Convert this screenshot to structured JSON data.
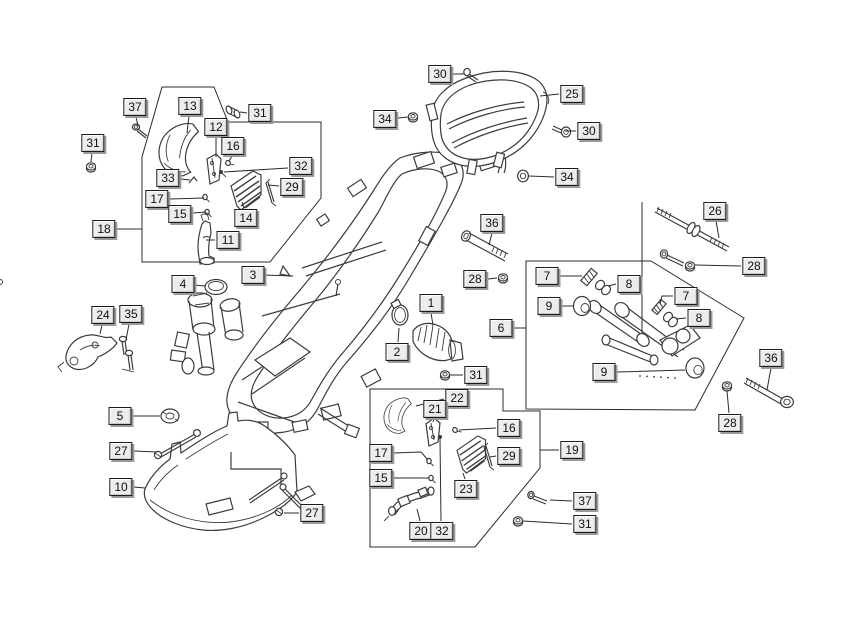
{
  "diagram": {
    "type": "exploded-parts-diagram",
    "subject": "scooter frame and footrest assembly",
    "colors": {
      "bg": "#ffffff",
      "line": "#3c3c3c",
      "label_bg": "#ececec",
      "label_border": "#1b1b1b",
      "label_shadow": "#9a9a9a",
      "text": "#111111"
    },
    "labels": [
      {
        "n": "37",
        "x": 135,
        "y": 107,
        "leader": [
          [
            136,
            117
          ],
          [
            138,
            126
          ]
        ]
      },
      {
        "n": "31",
        "x": 93,
        "y": 143,
        "leader": [
          [
            92,
            153
          ],
          [
            91,
            162
          ]
        ]
      },
      {
        "n": "13",
        "x": 190,
        "y": 106,
        "leader": [
          [
            189,
            116
          ],
          [
            187,
            133
          ]
        ]
      },
      {
        "n": "31",
        "x": 260,
        "y": 113,
        "leader": [
          [
            247,
            113
          ],
          [
            240,
            112
          ]
        ]
      },
      {
        "n": "12",
        "x": 216,
        "y": 127,
        "leader": [
          [
            216,
            137
          ],
          [
            216,
            157
          ]
        ]
      },
      {
        "n": "16",
        "x": 233,
        "y": 146,
        "leader": [
          [
            232,
            156
          ],
          [
            229,
            161
          ]
        ]
      },
      {
        "n": "32",
        "x": 301,
        "y": 166,
        "leader": [
          [
            288,
            168
          ],
          [
            224,
            172
          ]
        ]
      },
      {
        "n": "33",
        "x": 168,
        "y": 178,
        "leader": [
          [
            181,
            179
          ],
          [
            190,
            180
          ]
        ]
      },
      {
        "n": "29",
        "x": 292,
        "y": 187,
        "leader": [
          [
            279,
            186
          ],
          [
            268,
            185
          ]
        ]
      },
      {
        "n": "17",
        "x": 157,
        "y": 199,
        "leader": [
          [
            170,
            199
          ],
          [
            204,
            198
          ]
        ]
      },
      {
        "n": "15",
        "x": 180,
        "y": 214,
        "leader": [
          [
            193,
            213
          ],
          [
            206,
            212
          ]
        ]
      },
      {
        "n": "14",
        "x": 246,
        "y": 218,
        "leader": [
          [
            244,
            208
          ],
          [
            242,
            202
          ]
        ]
      },
      {
        "n": "18",
        "x": 104,
        "y": 229,
        "leader": [
          [
            117,
            229
          ],
          [
            142,
            229
          ]
        ]
      },
      {
        "n": "11",
        "x": 228,
        "y": 240,
        "leader": [
          [
            215,
            240
          ],
          [
            206,
            240
          ]
        ]
      },
      {
        "n": "4",
        "x": 183,
        "y": 284,
        "leader": [
          [
            194,
            285
          ],
          [
            205,
            286
          ]
        ]
      },
      {
        "n": "3",
        "x": 253,
        "y": 275,
        "leader": [
          [
            264,
            275
          ],
          [
            293,
            276
          ]
        ]
      },
      {
        "n": "30",
        "x": 440,
        "y": 74,
        "leader": [
          [
            453,
            74
          ],
          [
            464,
            74
          ]
        ]
      },
      {
        "n": "25",
        "x": 572,
        "y": 94,
        "leader": [
          [
            559,
            94
          ],
          [
            540,
            96
          ]
        ]
      },
      {
        "n": "34",
        "x": 385,
        "y": 119,
        "leader": [
          [
            398,
            118
          ],
          [
            408,
            117
          ]
        ]
      },
      {
        "n": "30",
        "x": 589,
        "y": 131,
        "leader": [
          [
            576,
            131
          ],
          [
            565,
            131
          ]
        ]
      },
      {
        "n": "34",
        "x": 567,
        "y": 177,
        "leader": [
          [
            554,
            177
          ],
          [
            529,
            176
          ]
        ]
      },
      {
        "n": "26",
        "x": 715,
        "y": 211,
        "leader": [
          [
            716,
            221
          ],
          [
            719,
            238
          ]
        ]
      },
      {
        "n": "28",
        "x": 754,
        "y": 266,
        "leader": [
          [
            741,
            266
          ],
          [
            695,
            265
          ]
        ]
      },
      {
        "n": "36",
        "x": 492,
        "y": 223,
        "leader": [
          [
            492,
            233
          ],
          [
            489,
            245
          ]
        ]
      },
      {
        "n": "28",
        "x": 475,
        "y": 279,
        "leader": [
          [
            488,
            279
          ],
          [
            497,
            278
          ]
        ]
      },
      {
        "n": "1",
        "x": 431,
        "y": 303,
        "leader": [
          [
            431,
            313
          ],
          [
            433,
            325
          ]
        ]
      },
      {
        "n": "2",
        "x": 397,
        "y": 352,
        "leader": [
          [
            398,
            342
          ],
          [
            399,
            328
          ]
        ]
      },
      {
        "n": "7",
        "x": 547,
        "y": 276,
        "leader": [
          [
            560,
            276
          ],
          [
            582,
            276
          ]
        ]
      },
      {
        "n": "8",
        "x": 629,
        "y": 284,
        "leader": [
          [
            616,
            284
          ],
          [
            608,
            286
          ]
        ]
      },
      {
        "n": "9",
        "x": 549,
        "y": 306,
        "leader": [
          [
            562,
            306
          ],
          [
            574,
            306
          ]
        ]
      },
      {
        "n": "6",
        "x": 501,
        "y": 328,
        "leader": [
          [
            514,
            328
          ],
          [
            526,
            328
          ]
        ]
      },
      {
        "n": "7",
        "x": 686,
        "y": 296,
        "leader": [
          [
            673,
            296
          ],
          [
            662,
            296
          ],
          [
            660,
            304
          ]
        ]
      },
      {
        "n": "8",
        "x": 699,
        "y": 318,
        "leader": [
          [
            686,
            318
          ],
          [
            676,
            319
          ]
        ]
      },
      {
        "n": "9",
        "x": 604,
        "y": 372,
        "leader": [
          [
            617,
            372
          ],
          [
            685,
            370
          ]
        ]
      },
      {
        "n": "36",
        "x": 771,
        "y": 358,
        "leader": [
          [
            771,
            368
          ],
          [
            767,
            390
          ]
        ]
      },
      {
        "n": "28",
        "x": 730,
        "y": 423,
        "leader": [
          [
            729,
            413
          ],
          [
            727,
            391
          ]
        ]
      },
      {
        "n": "24",
        "x": 103,
        "y": 315,
        "leader": [
          [
            102,
            325
          ],
          [
            100,
            334
          ]
        ]
      },
      {
        "n": "35",
        "x": 131,
        "y": 314,
        "leader": [
          [
            129,
            324
          ],
          [
            126,
            340
          ]
        ]
      },
      {
        "n": "5",
        "x": 120,
        "y": 416,
        "leader": [
          [
            131,
            416
          ],
          [
            160,
            416
          ]
        ]
      },
      {
        "n": "27",
        "x": 121,
        "y": 451,
        "leader": [
          [
            134,
            451
          ],
          [
            157,
            452
          ]
        ]
      },
      {
        "n": "10",
        "x": 121,
        "y": 487,
        "leader": [
          [
            134,
            487
          ],
          [
            145,
            488
          ]
        ]
      },
      {
        "n": "27",
        "x": 312,
        "y": 513,
        "leader": [
          [
            299,
            513
          ],
          [
            284,
            513
          ]
        ]
      },
      {
        "n": "31",
        "x": 476,
        "y": 375,
        "leader": [
          [
            463,
            375
          ],
          [
            450,
            375
          ]
        ]
      },
      {
        "n": "22",
        "x": 457,
        "y": 398,
        "leader": [
          [
            444,
            399
          ],
          [
            416,
            406
          ]
        ]
      },
      {
        "n": "21",
        "x": 435,
        "y": 409,
        "leader": [
          [
            434,
            419
          ],
          [
            433,
            422
          ]
        ]
      },
      {
        "n": "16",
        "x": 509,
        "y": 428,
        "leader": [
          [
            496,
            428
          ],
          [
            459,
            430
          ]
        ]
      },
      {
        "n": "29",
        "x": 509,
        "y": 456,
        "leader": [
          [
            496,
            456
          ],
          [
            490,
            457
          ]
        ]
      },
      {
        "n": "17",
        "x": 381,
        "y": 453,
        "leader": [
          [
            394,
            453
          ],
          [
            421,
            452
          ],
          [
            428,
            460
          ]
        ]
      },
      {
        "n": "15",
        "x": 381,
        "y": 478,
        "leader": [
          [
            394,
            478
          ],
          [
            429,
            478
          ]
        ]
      },
      {
        "n": "23",
        "x": 466,
        "y": 489,
        "leader": [
          [
            465,
            479
          ],
          [
            463,
            473
          ]
        ]
      },
      {
        "n": "20",
        "x": 421,
        "y": 531,
        "leader": [
          [
            420,
            521
          ],
          [
            417,
            509
          ]
        ]
      },
      {
        "n": "32",
        "x": 442,
        "y": 531,
        "leader": [
          [
            441,
            521
          ],
          [
            440,
            439
          ]
        ]
      },
      {
        "n": "19",
        "x": 572,
        "y": 450,
        "leader": [
          [
            559,
            450
          ],
          [
            540,
            450
          ]
        ]
      },
      {
        "n": "37",
        "x": 585,
        "y": 501,
        "leader": [
          [
            572,
            501
          ],
          [
            550,
            500
          ]
        ]
      },
      {
        "n": "31",
        "x": 585,
        "y": 524,
        "leader": [
          [
            572,
            524
          ],
          [
            523,
            521
          ]
        ]
      }
    ]
  }
}
